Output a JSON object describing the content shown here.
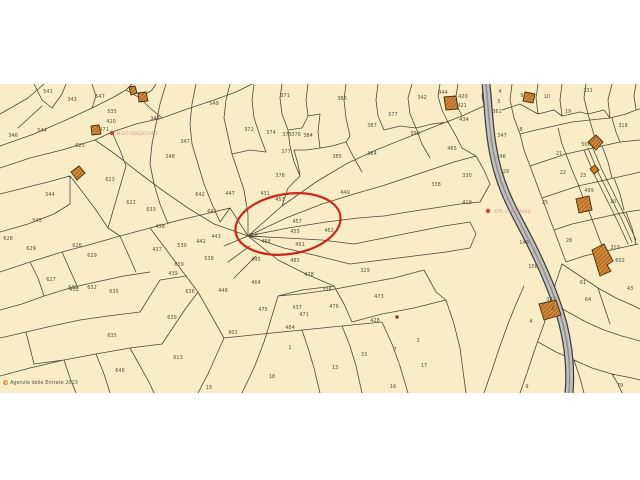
{
  "map": {
    "colors": {
      "background": "#f8edc6",
      "boundary_line": "#4b4a37",
      "label_text": "#55543c",
      "highlight": "#c8281e",
      "road_fill": "#c2c2c2",
      "road_casing": "#3f3f35",
      "road_core": "#8f8f8f",
      "building_fill": "#d4873a",
      "building_outline": "#4a2c08",
      "poi_text": "#e08898",
      "poi_dot": "#cc4040",
      "copyright_mark": "#d2691e"
    },
    "copyright_symbol": "©",
    "copyright_text": "Agenzia delle Entrate 2023",
    "highlight_ellipse": {
      "cx": 288,
      "cy": 140,
      "rx": 53,
      "ry": 30,
      "rotation": -9
    },
    "poi": [
      {
        "label": "B.GO COSOCCHIO",
        "x": 117,
        "y": 51,
        "dot_x": 112,
        "dot_y": 49
      },
      {
        "label": "STR. COMUNALE",
        "x": 494,
        "y": 129,
        "dot_x": 488,
        "dot_y": 127
      }
    ],
    "markers": [
      {
        "x": 397,
        "y": 233
      }
    ],
    "parcel_labels": [
      {
        "t": "541",
        "x": 48,
        "y": 9
      },
      {
        "t": "343",
        "x": 72,
        "y": 17
      },
      {
        "t": "547",
        "x": 100,
        "y": 14
      },
      {
        "t": "549",
        "x": 214,
        "y": 21
      },
      {
        "t": "535",
        "x": 112,
        "y": 29
      },
      {
        "t": "346",
        "x": 13,
        "y": 53
      },
      {
        "t": "544",
        "x": 42,
        "y": 48
      },
      {
        "t": "420",
        "x": 111,
        "y": 39
      },
      {
        "t": "471",
        "x": 104,
        "y": 47
      },
      {
        "t": "625",
        "x": 80,
        "y": 63
      },
      {
        "t": "346",
        "x": 155,
        "y": 36
      },
      {
        "t": "347",
        "x": 185,
        "y": 59
      },
      {
        "t": "348",
        "x": 170,
        "y": 74
      },
      {
        "t": "623",
        "x": 110,
        "y": 97
      },
      {
        "t": "544",
        "x": 50,
        "y": 112
      },
      {
        "t": "545",
        "x": 37,
        "y": 138
      },
      {
        "t": "628",
        "x": 8,
        "y": 156
      },
      {
        "t": "629",
        "x": 31,
        "y": 166
      },
      {
        "t": "626",
        "x": 77,
        "y": 163
      },
      {
        "t": "629",
        "x": 92,
        "y": 173
      },
      {
        "t": "627",
        "x": 51,
        "y": 197
      },
      {
        "t": "630",
        "x": 73,
        "y": 205
      },
      {
        "t": "632",
        "x": 92,
        "y": 205
      },
      {
        "t": "635",
        "x": 114,
        "y": 209
      },
      {
        "t": "622",
        "x": 131,
        "y": 120
      },
      {
        "t": "633",
        "x": 151,
        "y": 127
      },
      {
        "t": "438",
        "x": 160,
        "y": 144
      },
      {
        "t": "437",
        "x": 157,
        "y": 167
      },
      {
        "t": "642",
        "x": 200,
        "y": 112
      },
      {
        "t": "641",
        "x": 212,
        "y": 129
      },
      {
        "t": "530",
        "x": 182,
        "y": 163
      },
      {
        "t": "442",
        "x": 201,
        "y": 159
      },
      {
        "t": "443",
        "x": 216,
        "y": 154
      },
      {
        "t": "639",
        "x": 179,
        "y": 182
      },
      {
        "t": "439",
        "x": 173,
        "y": 191
      },
      {
        "t": "538",
        "x": 209,
        "y": 176
      },
      {
        "t": "636",
        "x": 190,
        "y": 209
      },
      {
        "t": "448",
        "x": 223,
        "y": 208
      },
      {
        "t": "639",
        "x": 172,
        "y": 235
      },
      {
        "t": "635",
        "x": 112,
        "y": 253
      },
      {
        "t": "613",
        "x": 178,
        "y": 275
      },
      {
        "t": "646",
        "x": 120,
        "y": 288
      },
      {
        "t": "432",
        "x": 74,
        "y": 207
      },
      {
        "t": "15",
        "x": 209,
        "y": 305
      },
      {
        "t": "371",
        "x": 285,
        "y": 13
      },
      {
        "t": "386",
        "x": 342,
        "y": 16
      },
      {
        "t": "372",
        "x": 249,
        "y": 47
      },
      {
        "t": "374",
        "x": 271,
        "y": 50
      },
      {
        "t": "375",
        "x": 287,
        "y": 52
      },
      {
        "t": "376",
        "x": 296,
        "y": 52
      },
      {
        "t": "384",
        "x": 308,
        "y": 53
      },
      {
        "t": "377",
        "x": 286,
        "y": 69
      },
      {
        "t": "378",
        "x": 280,
        "y": 93
      },
      {
        "t": "385",
        "x": 337,
        "y": 74
      },
      {
        "t": "387",
        "x": 372,
        "y": 43
      },
      {
        "t": "384",
        "x": 372,
        "y": 71
      },
      {
        "t": "577",
        "x": 393,
        "y": 32
      },
      {
        "t": "393",
        "x": 415,
        "y": 51
      },
      {
        "t": "342",
        "x": 422,
        "y": 15
      },
      {
        "t": "447",
        "x": 230,
        "y": 111
      },
      {
        "t": "431",
        "x": 265,
        "y": 111
      },
      {
        "t": "453",
        "x": 280,
        "y": 117
      },
      {
        "t": "449",
        "x": 345,
        "y": 110
      },
      {
        "t": "457",
        "x": 297,
        "y": 139
      },
      {
        "t": "455",
        "x": 295,
        "y": 149
      },
      {
        "t": "456",
        "x": 253,
        "y": 153
      },
      {
        "t": "458",
        "x": 266,
        "y": 159
      },
      {
        "t": "451",
        "x": 300,
        "y": 162
      },
      {
        "t": "462",
        "x": 329,
        "y": 148
      },
      {
        "t": "445",
        "x": 256,
        "y": 177
      },
      {
        "t": "485",
        "x": 295,
        "y": 178
      },
      {
        "t": "478",
        "x": 309,
        "y": 192
      },
      {
        "t": "464",
        "x": 256,
        "y": 200
      },
      {
        "t": "336",
        "x": 327,
        "y": 207
      },
      {
        "t": "329",
        "x": 365,
        "y": 188
      },
      {
        "t": "473",
        "x": 379,
        "y": 214
      },
      {
        "t": "476",
        "x": 334,
        "y": 224
      },
      {
        "t": "437",
        "x": 297,
        "y": 225
      },
      {
        "t": "471",
        "x": 304,
        "y": 232
      },
      {
        "t": "475",
        "x": 263,
        "y": 227
      },
      {
        "t": "484",
        "x": 290,
        "y": 245
      },
      {
        "t": "901",
        "x": 233,
        "y": 250
      },
      {
        "t": "1",
        "x": 290,
        "y": 265
      },
      {
        "t": "33",
        "x": 364,
        "y": 272
      },
      {
        "t": "13",
        "x": 335,
        "y": 285
      },
      {
        "t": "18",
        "x": 272,
        "y": 294
      },
      {
        "t": "16",
        "x": 393,
        "y": 304
      },
      {
        "t": "428",
        "x": 375,
        "y": 238
      },
      {
        "t": "3",
        "x": 418,
        "y": 258
      },
      {
        "t": "7",
        "x": 395,
        "y": 267
      },
      {
        "t": "17",
        "x": 424,
        "y": 283
      },
      {
        "t": "344",
        "x": 443,
        "y": 10
      },
      {
        "t": "420",
        "x": 463,
        "y": 14
      },
      {
        "t": "421",
        "x": 462,
        "y": 23
      },
      {
        "t": "434",
        "x": 464,
        "y": 37
      },
      {
        "t": "4",
        "x": 500,
        "y": 9
      },
      {
        "t": "9",
        "x": 522,
        "y": 13
      },
      {
        "t": "10",
        "x": 547,
        "y": 14
      },
      {
        "t": "331",
        "x": 588,
        "y": 8
      },
      {
        "t": "5",
        "x": 499,
        "y": 19
      },
      {
        "t": "361",
        "x": 497,
        "y": 29
      },
      {
        "t": "19",
        "x": 568,
        "y": 29
      },
      {
        "t": "8",
        "x": 521,
        "y": 47
      },
      {
        "t": "347",
        "x": 502,
        "y": 53
      },
      {
        "t": "465",
        "x": 452,
        "y": 66
      },
      {
        "t": "318",
        "x": 623,
        "y": 43
      },
      {
        "t": "506",
        "x": 586,
        "y": 62
      },
      {
        "t": "21",
        "x": 559,
        "y": 71
      },
      {
        "t": "330",
        "x": 467,
        "y": 93
      },
      {
        "t": "338",
        "x": 436,
        "y": 102
      },
      {
        "t": "22",
        "x": 563,
        "y": 90
      },
      {
        "t": "23",
        "x": 583,
        "y": 93
      },
      {
        "t": "25",
        "x": 545,
        "y": 120
      },
      {
        "t": "499",
        "x": 589,
        "y": 108
      },
      {
        "t": "10",
        "x": 613,
        "y": 119
      },
      {
        "t": "419",
        "x": 467,
        "y": 120
      },
      {
        "t": "29",
        "x": 506,
        "y": 89
      },
      {
        "t": "346",
        "x": 501,
        "y": 74
      },
      {
        "t": "149",
        "x": 524,
        "y": 160
      },
      {
        "t": "28",
        "x": 569,
        "y": 158
      },
      {
        "t": "319",
        "x": 615,
        "y": 165
      },
      {
        "t": "108",
        "x": 533,
        "y": 184
      },
      {
        "t": "602",
        "x": 620,
        "y": 178
      },
      {
        "t": "43",
        "x": 630,
        "y": 206
      },
      {
        "t": "61",
        "x": 583,
        "y": 200
      },
      {
        "t": "341",
        "x": 551,
        "y": 217
      },
      {
        "t": "64",
        "x": 588,
        "y": 217
      },
      {
        "t": "1",
        "x": 553,
        "y": 226
      },
      {
        "t": "4",
        "x": 531,
        "y": 239
      },
      {
        "t": "79",
        "x": 620,
        "y": 303
      },
      {
        "t": "9",
        "x": 527,
        "y": 304
      }
    ]
  }
}
